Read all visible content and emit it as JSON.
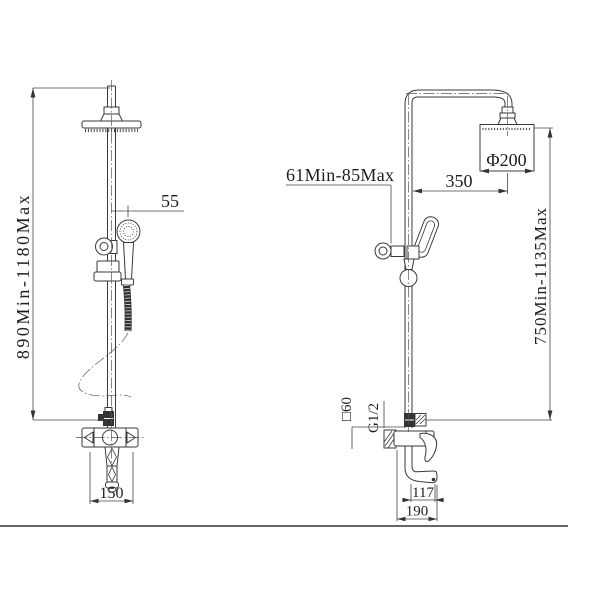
{
  "drawing": {
    "front": {
      "height_range": "890Min-1180Max",
      "handshower_offset": "55",
      "inlet_spacing": "150"
    },
    "side": {
      "wall_distance": "61Min-85Max",
      "arm_reach": "350",
      "head_diameter": "Φ200",
      "riser_range": "750Min-1135Max",
      "body_square": "□60",
      "thread_size": "G1/2",
      "spout_reach": "117",
      "spout_overall": "190"
    }
  }
}
